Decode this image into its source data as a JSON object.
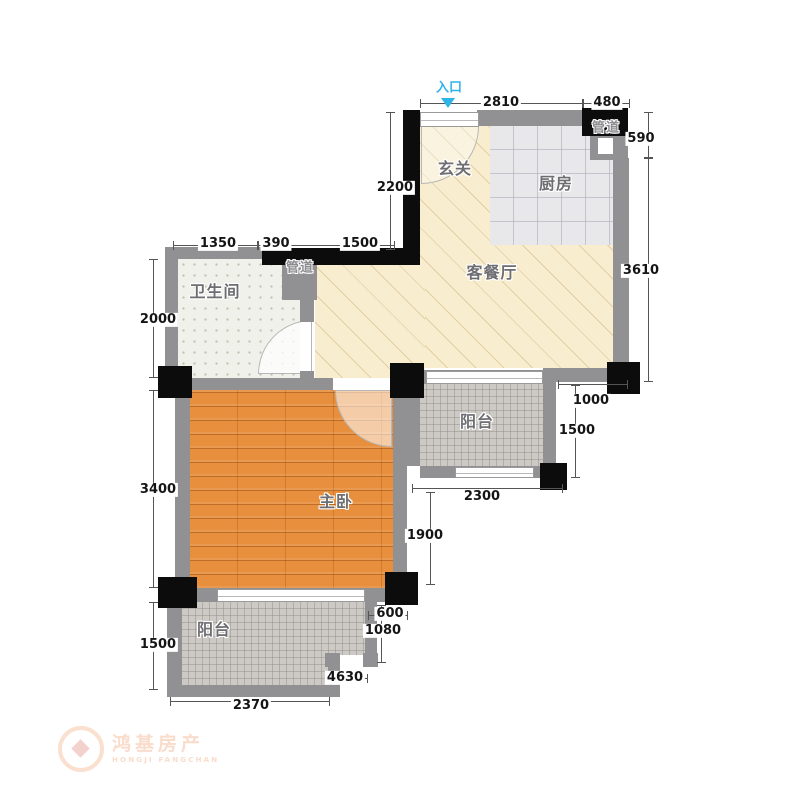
{
  "entry": {
    "label": "入口"
  },
  "rooms": {
    "foyer": "玄关",
    "kitchen": "厨房",
    "living_dining": "客餐厅",
    "bathroom": "卫生间",
    "master_bedroom": "主卧",
    "balcony_right": "阳台",
    "balcony_bottom": "阳台",
    "duct_kitchen": "管道",
    "duct_bathroom": "管道"
  },
  "dimensions": {
    "top_w1": "2810",
    "top_w2": "480",
    "right_v1": "590",
    "right_v2": "3610",
    "foyer_left_v": "2200",
    "bath_w1": "1350",
    "bath_w2": "390",
    "bath_w3": "1500",
    "left_v1": "2000",
    "left_v2": "3400",
    "left_v3": "1500",
    "mid_w1": "1000",
    "mid_v1": "1500",
    "mid_w2": "2300",
    "mid_v2": "1900",
    "low_w1": "600",
    "low_v1": "1080",
    "low_w2": "4630",
    "low_w3": "2370"
  },
  "watermark": {
    "name_cn": "鸿基房产",
    "name_en": "HONGJI FANGCHAN"
  },
  "colors": {
    "wall": "#919194",
    "column": "#0c0c0c",
    "living_floor": "#f8edcf",
    "kitchen_floor": "#e8e8eb",
    "bathroom_floor": "#eff1ea",
    "bedroom_floor": "#e78f3c",
    "balcony_floor": "#cdcac6",
    "entry_arrow": "#2fb4e9",
    "dimension_text": "#151515",
    "room_label_text": "#6e6e72"
  }
}
